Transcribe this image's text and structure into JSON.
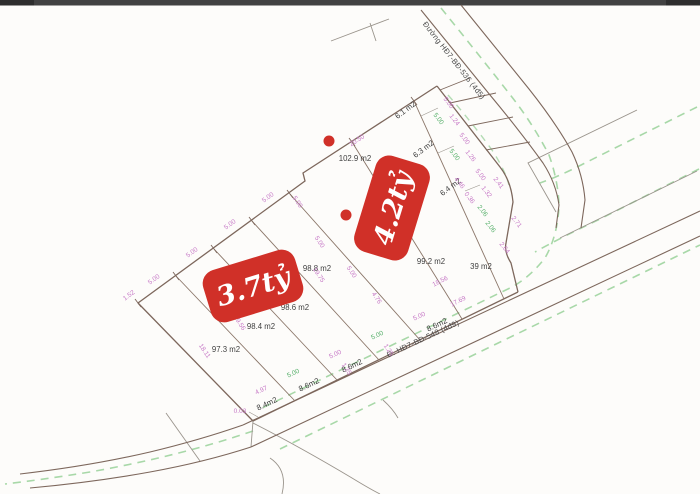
{
  "map": {
    "roads": {
      "top": {
        "label": "Đường HĐ7-BĐ-536 (4đ5)"
      },
      "bottom": {
        "label": "Đ. HĐ7-BĐ-548 (4đ9)"
      }
    },
    "badges": {
      "left_price": "3.7tỷ",
      "right_price": "4.2tỷ"
    },
    "area_labels": [
      {
        "text": "102.9 m2"
      },
      {
        "text": "99.2 m2"
      },
      {
        "text": "39 m2"
      },
      {
        "text": "98.8 m2"
      },
      {
        "text": "98.6 m2"
      },
      {
        "text": "98.4 m2"
      },
      {
        "text": "97.3 m2"
      },
      {
        "text": "6.1 m2"
      },
      {
        "text": "6.3 m2"
      },
      {
        "text": "6.4 m2"
      },
      {
        "text": "8.4m2"
      },
      {
        "text": "8.6m2"
      },
      {
        "text": "8.6m2"
      },
      {
        "text": "8.6m2"
      }
    ],
    "dims": [
      {
        "t": "1.52"
      },
      {
        "t": "5.00"
      },
      {
        "t": "5.00"
      },
      {
        "t": "5.00"
      },
      {
        "t": "5.00"
      },
      {
        "t": "20.50"
      },
      {
        "t": "18.11"
      },
      {
        "t": "19.56"
      },
      {
        "t": "19.70"
      },
      {
        "t": "19.75"
      },
      {
        "t": "4.76"
      },
      {
        "t": "4.97"
      },
      {
        "t": "0.03"
      },
      {
        "t": "5.00"
      },
      {
        "t": "5.00"
      },
      {
        "t": "5.00"
      },
      {
        "t": "5.00"
      },
      {
        "t": "1.25"
      },
      {
        "t": "1.25"
      },
      {
        "t": "18.56"
      },
      {
        "t": "17.69"
      },
      {
        "t": "5.00"
      },
      {
        "t": "1.24"
      },
      {
        "t": "5.00"
      },
      {
        "t": "1.26"
      },
      {
        "t": "5.00"
      },
      {
        "t": "1.32"
      },
      {
        "t": "5.00"
      },
      {
        "t": "5.00"
      },
      {
        "t": "4.46"
      },
      {
        "t": "0.36"
      },
      {
        "t": "2.06"
      },
      {
        "t": "2.06"
      },
      {
        "t": "2.41"
      },
      {
        "t": "2.71"
      },
      {
        "t": "2.64"
      },
      {
        "t": "5.00"
      },
      {
        "t": "5.00"
      },
      {
        "t": "5.00"
      }
    ],
    "colors": {
      "price_badge_red": "#d03028",
      "dimension_pink": "#c678c6",
      "dimension_green": "#53ae67",
      "parcel_line_brown": "#7d675c",
      "planning_dashed_green": "#a8d8a8"
    }
  }
}
